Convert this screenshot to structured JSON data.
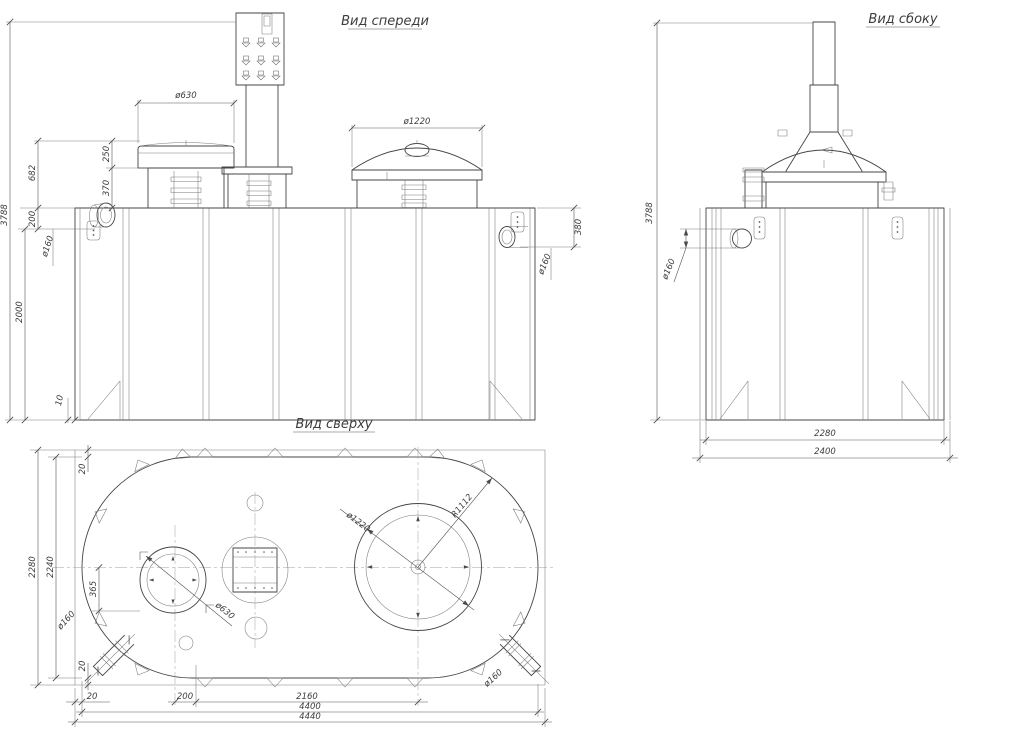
{
  "views": {
    "front": {
      "title": "Вид спереди",
      "dims": {
        "total_height": "3788",
        "body_height": "2000",
        "top_to_pipe": "200",
        "hatch_to_top": "682",
        "lid_height": "250",
        "neck_height": "370",
        "base_lip": "10",
        "hatch_dia": "ø630",
        "dome_dia": "ø1220",
        "pipe_left_dia": "ø160",
        "pipe_right_dia": "ø160",
        "pipe_right_offset": "380"
      }
    },
    "side": {
      "title": "Вид сбоку",
      "dims": {
        "total_height": "3788",
        "pipe_dia": "ø160",
        "body_width": "2280",
        "overall_width": "2400"
      }
    },
    "top": {
      "title": "Вид сверху",
      "dims": {
        "overall_depth": "2280",
        "body_depth": "2240",
        "pipe_offset": "365",
        "margin_top": "20",
        "margin_bottom": "20",
        "margin_left": "20",
        "hatch_offset": "200",
        "hatch_spacing": "2160",
        "body_length": "4400",
        "overall_length": "4440",
        "hatch_dia": "ø630",
        "dome_dia": "ø1220",
        "dome_radius": "R1112",
        "pipe_left_dia": "ø160",
        "pipe_right_dia": "ø160"
      }
    }
  }
}
